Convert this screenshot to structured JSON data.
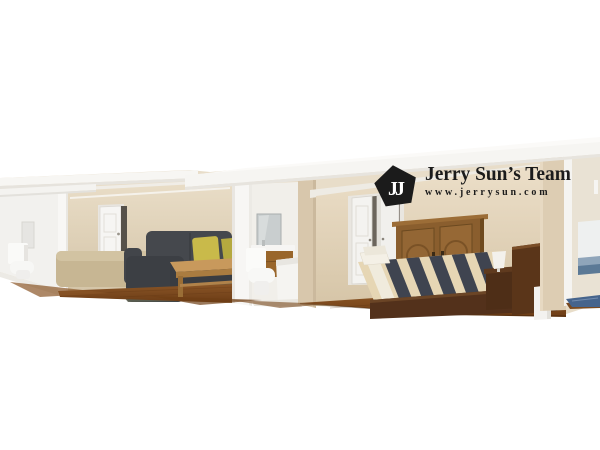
{
  "watermark": {
    "monogram": "JJ",
    "title": "Jerry Sun’s Team",
    "website": "www.jerrysun.com"
  },
  "scene": {
    "alt": "3D cutaway rendering of a single-story home interior showing a small bathroom, living room with gray sectional sofa, a second bathroom, and a master bedroom with bed and armoire on wood floors"
  },
  "palette": {
    "background": "#ffffff",
    "roof_white": "#f6f5f2",
    "wall_beige": "#d8c7ac",
    "wall_white": "#f2f1ee",
    "floor_wood": "#7c4a20",
    "sofa_dark": "#45484d",
    "sofa_beige": "#c7b693",
    "pillow_yellow": "#c9ba4a",
    "table_wood": "#c8995c",
    "vanity_wood": "#99662b",
    "armoire_wood": "#8a5e2e",
    "bed_frame": "#53311b",
    "duvet_base": "#e6d6b4",
    "duvet_stripe_dark": "#3f4450",
    "rug_blue": "#46648c",
    "logo_black": "#1b1b1b"
  }
}
